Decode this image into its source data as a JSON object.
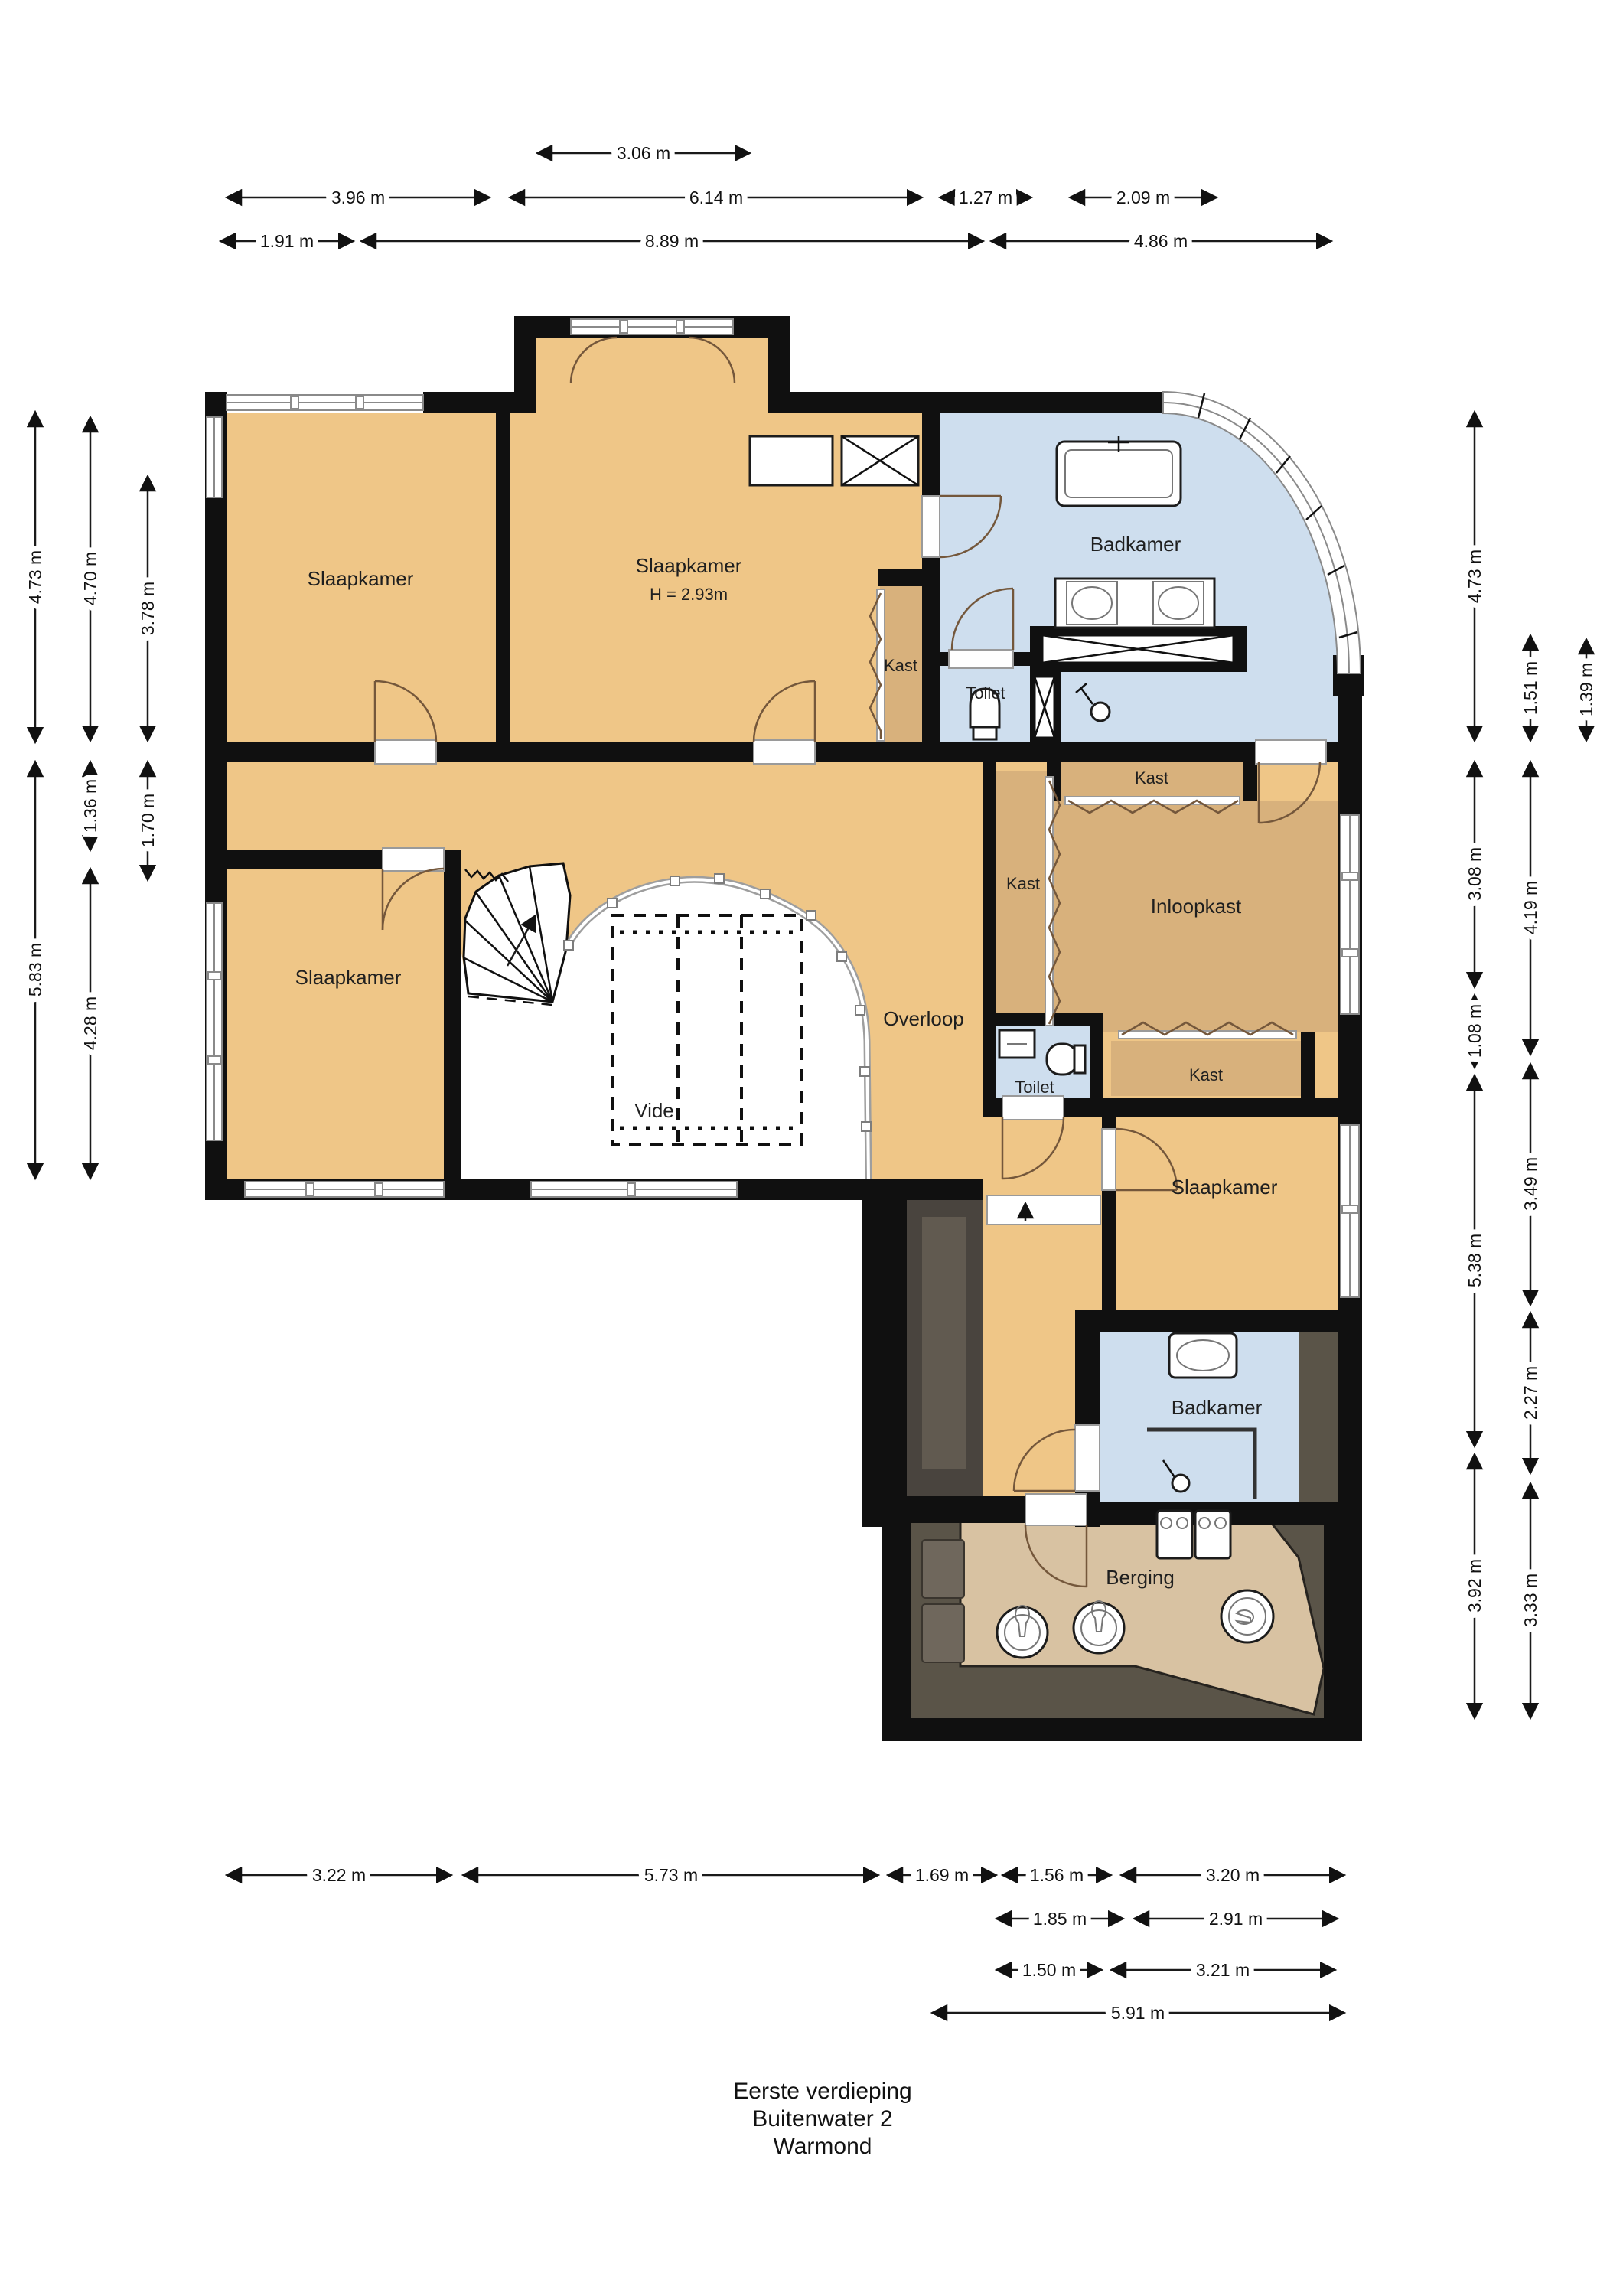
{
  "document": {
    "type": "floor-plan",
    "floor": "Eerste verdieping",
    "address": "Buitenwater 2",
    "city": "Warmond"
  },
  "title": {
    "line1": "Eerste verdieping",
    "line2": "Buitenwater 2",
    "line3": "Warmond"
  },
  "rooms": {
    "slaapkamer_tl": "Slaapkamer",
    "slaapkamer_tc": "Slaapkamer",
    "slaapkamer_tc_height": "H = 2.93m",
    "badkamer_top": "Badkamer",
    "kast_bedroom2": "Kast",
    "toilet_top": "Toilet",
    "kast_top": "Kast",
    "kast_mid": "Kast",
    "inloopkast": "Inloopkast",
    "overloop": "Overloop",
    "toilet_mid": "Toilet",
    "kast_lower": "Kast",
    "vide": "Vide",
    "slaapkamer_bl": "Slaapkamer",
    "slaapkamer_br": "Slaapkamer",
    "badkamer_bottom": "Badkamer",
    "berging": "Berging"
  },
  "dimensions": {
    "top": [
      "3.06 m",
      "3.96 m",
      "6.14 m",
      "1.27 m",
      "2.09 m",
      "1.91 m",
      "8.89 m",
      "4.86 m"
    ],
    "left": [
      "4.73 m",
      "5.83 m",
      "4.70 m",
      "1.36 m",
      "4.28 m",
      "3.78 m",
      "1.70 m"
    ],
    "right": [
      "4.73 m",
      "3.08 m",
      "1.08 m",
      "5.38 m",
      "3.92 m",
      "1.51 m",
      "4.19 m",
      "3.49 m",
      "2.27 m",
      "3.33 m",
      "1.39 m"
    ],
    "bottom": [
      "3.22 m",
      "5.73 m",
      "1.69 m",
      "1.56 m",
      "3.20 m",
      "1.85 m",
      "2.91 m",
      "1.50 m",
      "3.21 m",
      "5.91 m"
    ]
  },
  "colors": {
    "floor_tan": "#efc687",
    "floor_closet": "#d8b17c",
    "floor_bath_blue": "#cedeee",
    "floor_storage_beige": "#d8c2a2",
    "roof_dark_olive": "#5a5448",
    "wall_black": "#101010"
  }
}
